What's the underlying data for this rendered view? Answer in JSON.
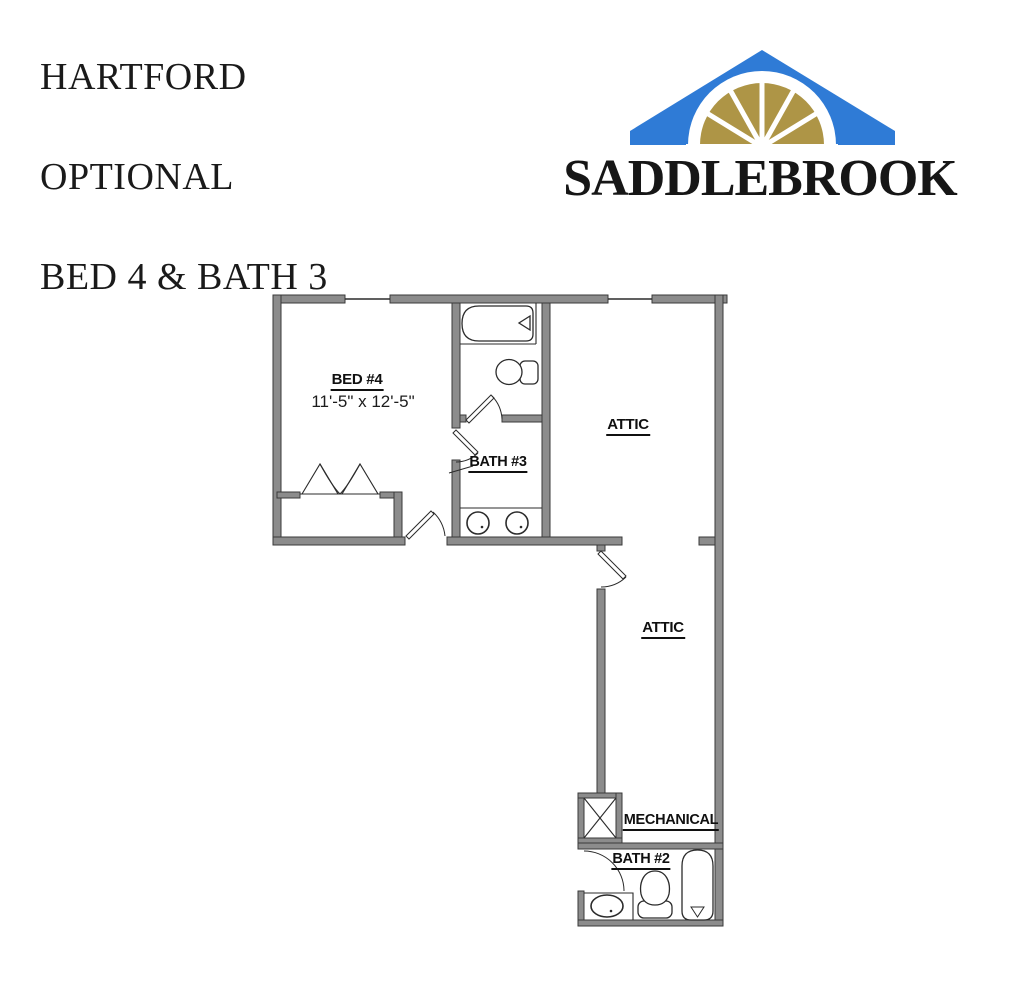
{
  "title": {
    "lines": [
      "HARTFORD",
      "OPTIONAL",
      "BED 4 & BATH 3"
    ]
  },
  "logo": {
    "brand": "SADDLEBROOK",
    "colors": {
      "roof_blue": "#2F7BD6",
      "fan_gold": "#AE9546",
      "text": "#161616"
    }
  },
  "floorplan": {
    "wall_fill": "#8C8C8C",
    "wall_edge": "#3A3A3A",
    "line_color": "#2B2B2B",
    "rooms": [
      {
        "id": "bed-4",
        "label": "BED #4",
        "dimensions": "11'-5\" x 12'-5\""
      },
      {
        "id": "bath-3",
        "label": "BATH #3"
      },
      {
        "id": "attic-upper",
        "label": "ATTIC"
      },
      {
        "id": "attic-lower",
        "label": "ATTIC"
      },
      {
        "id": "mechanical",
        "label": "MECHANICAL"
      },
      {
        "id": "bath-2",
        "label": "BATH #2"
      }
    ],
    "fixture_icons": [
      "bathtub-icon",
      "toilet-icon",
      "sink-icon",
      "bifold-closet-doors-icon",
      "door-swing-icon",
      "window-icon",
      "mechanical-chase-icon"
    ]
  }
}
